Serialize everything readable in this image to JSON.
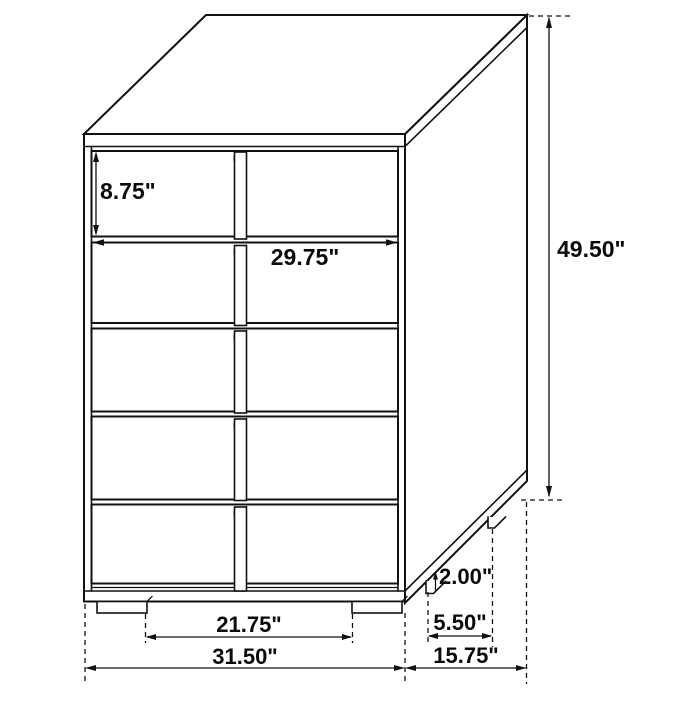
{
  "meta": {
    "description": "Technical dimension diagram of a five-drawer chest with vertical center drawer pulls, shown in oblique projection with measurement callouts",
    "drawer_count": 5,
    "unit": "inches"
  },
  "colors": {
    "line": "#111111",
    "text": "#0a0a0a",
    "background": "#ffffff"
  },
  "dims": {
    "top_drawer_height": "8.75\"",
    "interior_width": "29.75\"",
    "overall_height": "49.50\"",
    "foot_height": "2.00\"",
    "back_foot_inset": "5.50\"",
    "overall_depth": "15.75\"",
    "foot_span": "21.75\"",
    "overall_width": "31.50\""
  }
}
